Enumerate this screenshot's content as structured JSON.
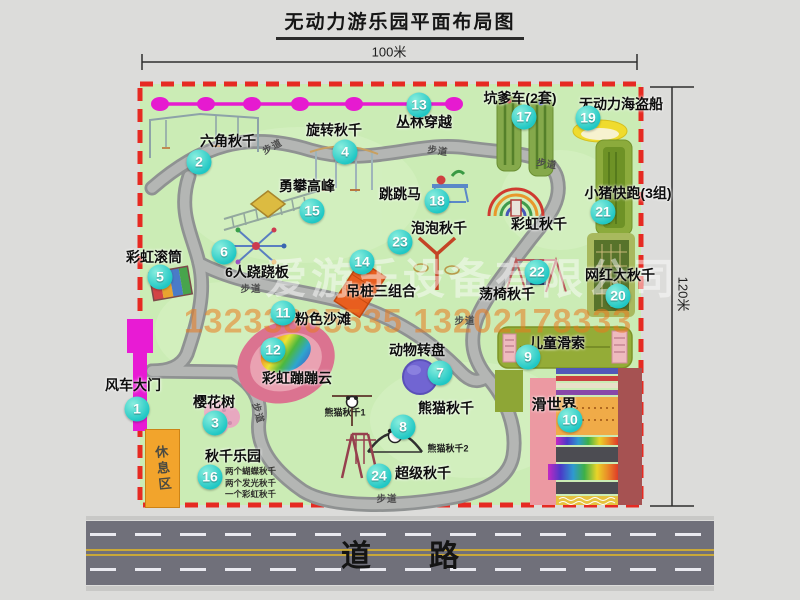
{
  "title": "无动力游乐园平面布局图",
  "dimensions": {
    "top": "100米",
    "right": "120米"
  },
  "road": {
    "label": "道路"
  },
  "watermark": {
    "company": "爱游乐设备有限公司",
    "phone": "13233805535 13202178333"
  },
  "rest_area": {
    "label": "休息区"
  },
  "trail": {
    "text": "步道",
    "positions": [
      {
        "x": 272,
        "y": 146,
        "r": -28
      },
      {
        "x": 438,
        "y": 150,
        "r": 8
      },
      {
        "x": 547,
        "y": 163,
        "r": 10
      },
      {
        "x": 251,
        "y": 288,
        "r": 0
      },
      {
        "x": 259,
        "y": 413,
        "r": 75
      },
      {
        "x": 465,
        "y": 320,
        "r": 0
      },
      {
        "x": 387,
        "y": 498,
        "r": 0
      }
    ]
  },
  "attractions": [
    {
      "num": "1",
      "label": "风车大门",
      "lx": 133,
      "ly": 385,
      "bx": 137,
      "by": 409
    },
    {
      "num": "2",
      "label": "六角秋千",
      "lx": 228,
      "ly": 141,
      "bx": 199,
      "by": 162
    },
    {
      "num": "3",
      "label": "樱花树",
      "lx": 214,
      "ly": 402,
      "bx": 215,
      "by": 423
    },
    {
      "num": "4",
      "label": "旋转秋千",
      "lx": 334,
      "ly": 130,
      "bx": 345,
      "by": 152
    },
    {
      "num": "5",
      "label": "彩虹滚筒",
      "lx": 154,
      "ly": 257,
      "bx": 160,
      "by": 277
    },
    {
      "num": "6",
      "label": "6人跷跷板",
      "lx": 257,
      "ly": 272,
      "bx": 224,
      "by": 252
    },
    {
      "num": "7",
      "label": "动物转盘",
      "lx": 417,
      "ly": 350,
      "bx": 440,
      "by": 373
    },
    {
      "num": "8",
      "label": "熊猫秋千",
      "lx": 446,
      "ly": 408,
      "bx": 403,
      "by": 427
    },
    {
      "num": "9",
      "label": "儿童滑索",
      "lx": 557,
      "ly": 343,
      "bx": 528,
      "by": 357
    },
    {
      "num": "10",
      "label": "滑世界",
      "lx": 554,
      "ly": 404,
      "bx": 570,
      "by": 420,
      "fs": 15
    },
    {
      "num": "11",
      "label": "粉色沙滩",
      "lx": 323,
      "ly": 319,
      "bx": 283,
      "by": 313
    },
    {
      "num": "12",
      "label": "彩虹蹦蹦云",
      "lx": 297,
      "ly": 378,
      "bx": 273,
      "by": 350
    },
    {
      "num": "13",
      "label": "丛林穿越",
      "lx": 424,
      "ly": 122,
      "bx": 419,
      "by": 105
    },
    {
      "num": "14",
      "label": "吊桩三组合",
      "lx": 381,
      "ly": 291,
      "bx": 362,
      "by": 262
    },
    {
      "num": "15",
      "label": "勇攀高峰",
      "lx": 307,
      "ly": 186,
      "bx": 312,
      "by": 211
    },
    {
      "num": "16",
      "label": "秋千乐园",
      "lx": 233,
      "ly": 456,
      "bx": 210,
      "by": 477
    },
    {
      "num": "17",
      "label": "坑爹车(2套)",
      "lx": 520,
      "ly": 98,
      "bx": 524,
      "by": 117
    },
    {
      "num": "18",
      "label": "跳跳马",
      "lx": 400,
      "ly": 194,
      "bx": 437,
      "by": 201
    },
    {
      "num": "19",
      "label": "无动力海盗船",
      "lx": 621,
      "ly": 104,
      "bx": 588,
      "by": 118
    },
    {
      "num": "20",
      "label": "网红大秋千",
      "lx": 620,
      "ly": 275,
      "bx": 618,
      "by": 296
    },
    {
      "num": "21",
      "label": "小猪快跑(3组)",
      "lx": 628,
      "ly": 193,
      "bx": 603,
      "by": 212
    },
    {
      "num": "22",
      "label": "荡椅秋千",
      "lx": 507,
      "ly": 294,
      "bx": 537,
      "by": 272
    },
    {
      "num": "23",
      "label": "泡泡秋千",
      "lx": 439,
      "ly": 228,
      "bx": 400,
      "by": 242
    },
    {
      "num": "24",
      "label": "超级秋千",
      "lx": 423,
      "ly": 473,
      "bx": 379,
      "by": 476
    },
    {
      "num": null,
      "label": "彩虹秋千",
      "lx": 539,
      "ly": 224,
      "bx": null,
      "by": null
    }
  ],
  "small_texts": [
    {
      "text": "熊猫秋千1",
      "x": 345,
      "y": 412
    },
    {
      "text": "熊猫秋千2",
      "x": 448,
      "y": 448
    }
  ],
  "swing_park_note": {
    "x": 225,
    "y": 466,
    "lines": [
      "两个蝴蝶秋千",
      "两个发光秋千",
      "一个彩虹秋千"
    ]
  },
  "colors": {
    "map_green": "#cbecb5",
    "border_red": "#e62a22",
    "badge_teal": "#1fc7c4",
    "gate_magenta": "#e81bd4",
    "rest_orange": "#f2a42c",
    "road_gray": "#70707a"
  }
}
